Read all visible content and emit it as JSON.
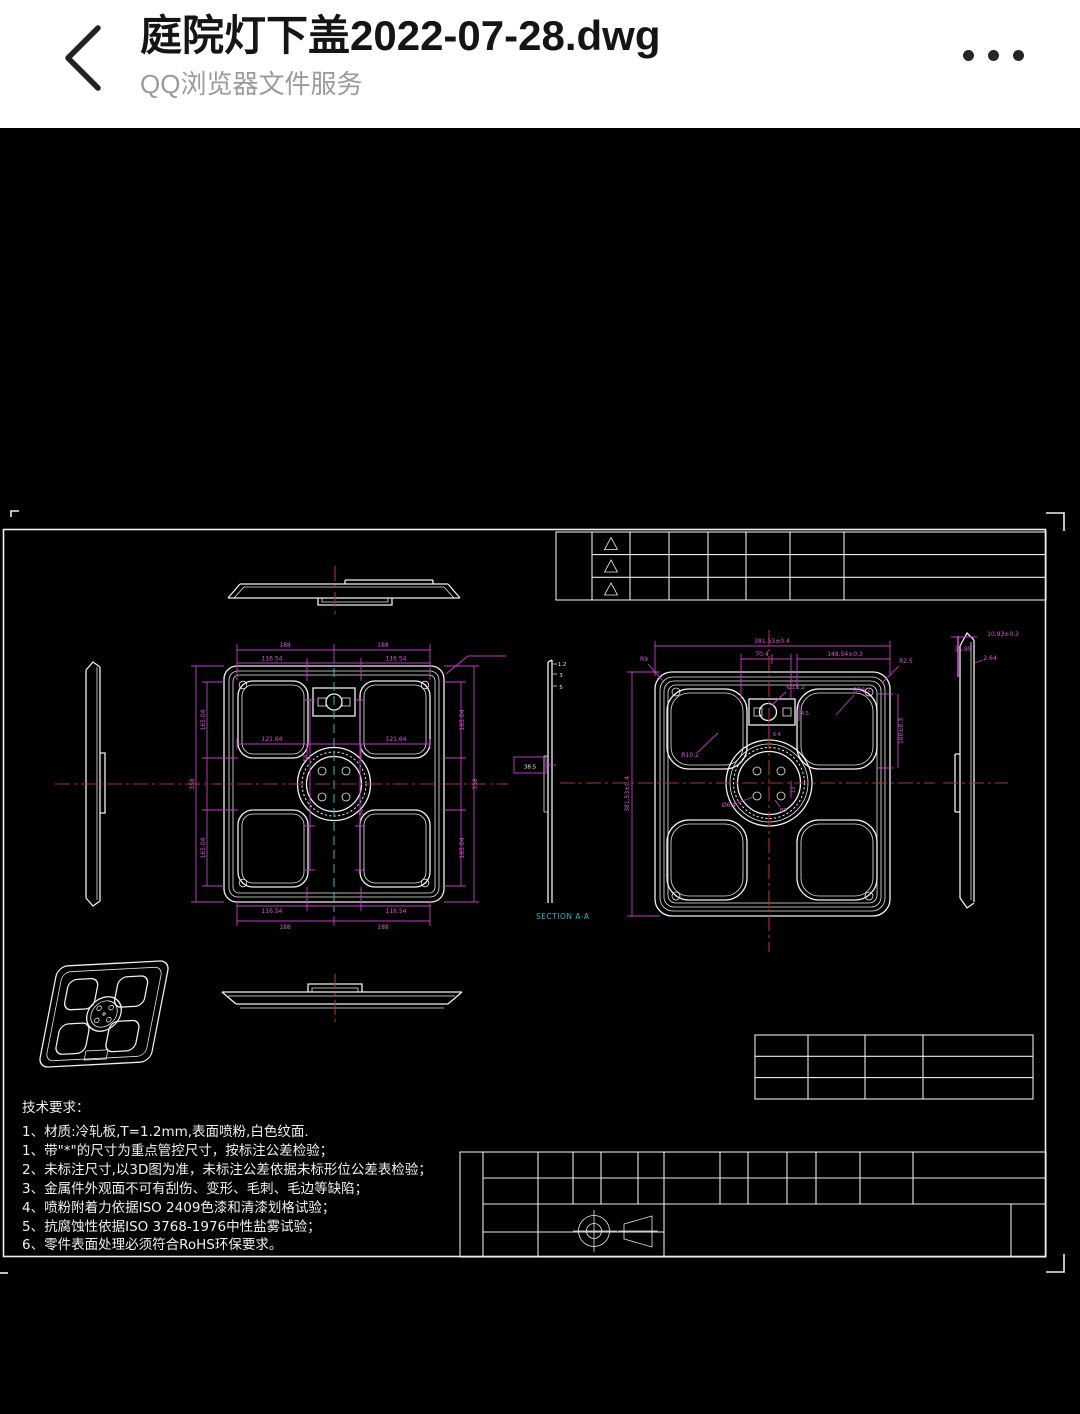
{
  "header": {
    "title": "庭院灯下盖2022-07-28.dwg",
    "subtitle": "QQ浏览器文件服务"
  },
  "colors": {
    "dimension_magenta": "#c63cc6",
    "centerline_red": "#a83434",
    "centerline_cyan": "#2fb8b8",
    "line_white": "#f0f0f0",
    "background": "#000000",
    "header_background": "#ffffff"
  },
  "drawing": {
    "section_label": "SECTION A-A",
    "tech": {
      "heading": "技术要求：",
      "items": [
        "1、材质:冷轧板,T=1.2mm,表面喷粉,白色纹面.",
        "1、带\"*\"的尺寸为重点管控尺寸，按标注公差检验；",
        "2、未标注尺寸,以3D图为准，未标注公差依据未标形位公差表检验；",
        "3、金属件外观面不可有刮伤、变形、毛刺、毛边等缺陷；",
        "4、喷粉附着力依据ISO 2409色漆和清漆划格试验；",
        "5、抗腐蚀性依据ISO 3768-1976中性盐雾试验；",
        "6、零件表面处理必须符合RoHS环保要求。"
      ]
    },
    "left_dims": [
      "188",
      "188",
      "116.54",
      "116.54",
      "121.64",
      "121.64",
      "116.54",
      "116.54",
      "188",
      "188",
      "165.04",
      "165.04",
      "358",
      "165.04",
      "165.04",
      "358",
      "58",
      "58"
    ],
    "right_dims": [
      "381.53±0.4",
      "70.4",
      "148.54±0.3",
      "381.53±0.4",
      "100±0.3",
      "R9",
      "R2.5",
      "R38.1",
      "R10.2",
      "Ø15.2",
      "4.5",
      "6.4",
      "Ø6.4",
      "Ø8",
      "13"
    ],
    "side_dims": [
      "10.93±0.3",
      "35.95",
      "2.64"
    ],
    "strip_dims": [
      "1.2",
      "3",
      "5",
      "38.5"
    ]
  }
}
